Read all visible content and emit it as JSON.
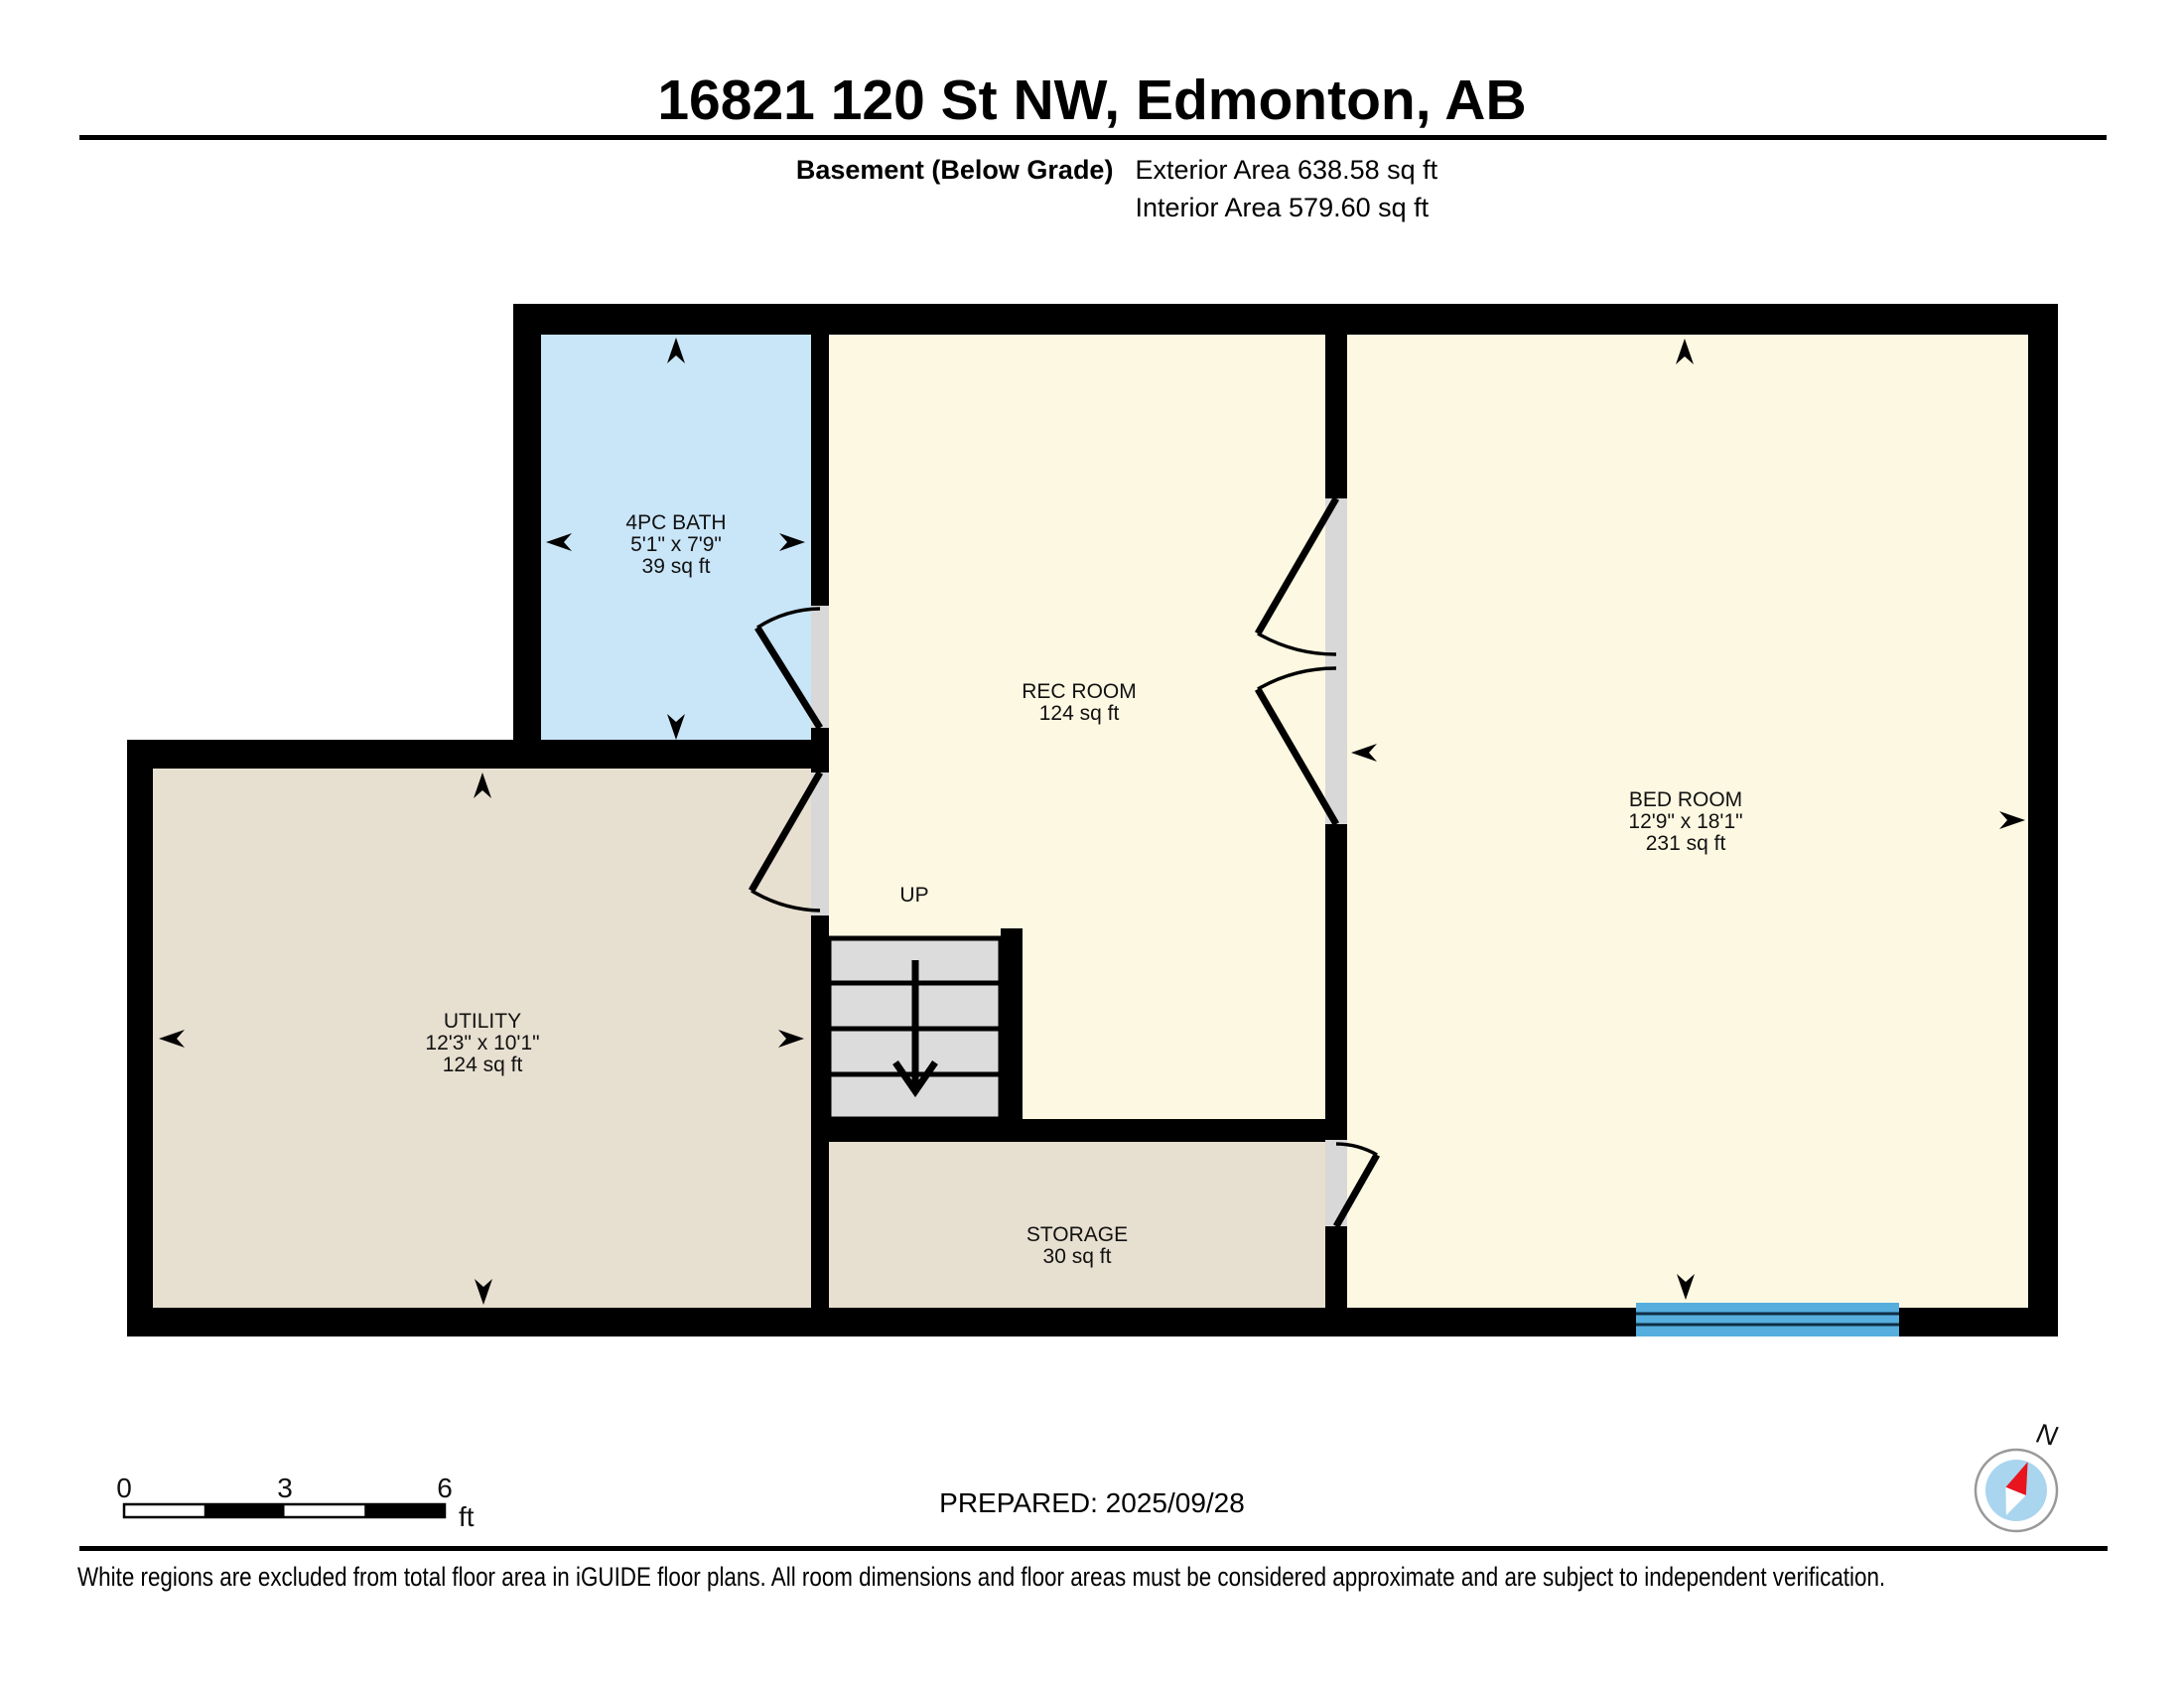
{
  "header": {
    "title": "16821 120 St NW, Edmonton, AB",
    "floor_label": "Basement (Below Grade)",
    "exterior_area": "Exterior Area 638.58 sq ft",
    "interior_area": "Interior Area 579.60 sq ft"
  },
  "rooms": {
    "bath": {
      "name": "4PC BATH",
      "dims": "5'1\" x 7'9\"",
      "area": "39 sq ft"
    },
    "rec": {
      "name": "REC ROOM",
      "area": "124 sq ft"
    },
    "bed": {
      "name": "BED ROOM",
      "dims": "12'9\" x 18'1\"",
      "area": "231 sq ft"
    },
    "utility": {
      "name": "UTILITY",
      "dims": "12'3\" x 10'1\"",
      "area": "124 sq ft"
    },
    "storage": {
      "name": "STORAGE",
      "area": "30 sq ft"
    }
  },
  "stairs": {
    "label": "UP"
  },
  "scale_bar": {
    "tick0": "0",
    "tick3": "3",
    "tick6": "6",
    "unit": "ft"
  },
  "prepared": "PREPARED: 2025/09/28",
  "compass": {
    "label": "N"
  },
  "footer": {
    "disclaimer": "White regions are excluded from total floor area in iGUIDE floor plans. All room dimensions and floor areas must be considered approximate and are subject to independent verification."
  },
  "colors": {
    "wall": "#000000",
    "bath": "#c9e5f8",
    "room_cream": "#fdf8e2",
    "tan": "#e7dfd0",
    "door_opening": "#d8d8d8",
    "stairs": "#dcdcdc",
    "window": "#55aede",
    "window_line": "#0e2e44",
    "compass_inner": "#a9d5ef",
    "compass_needle": "#e8141e"
  }
}
